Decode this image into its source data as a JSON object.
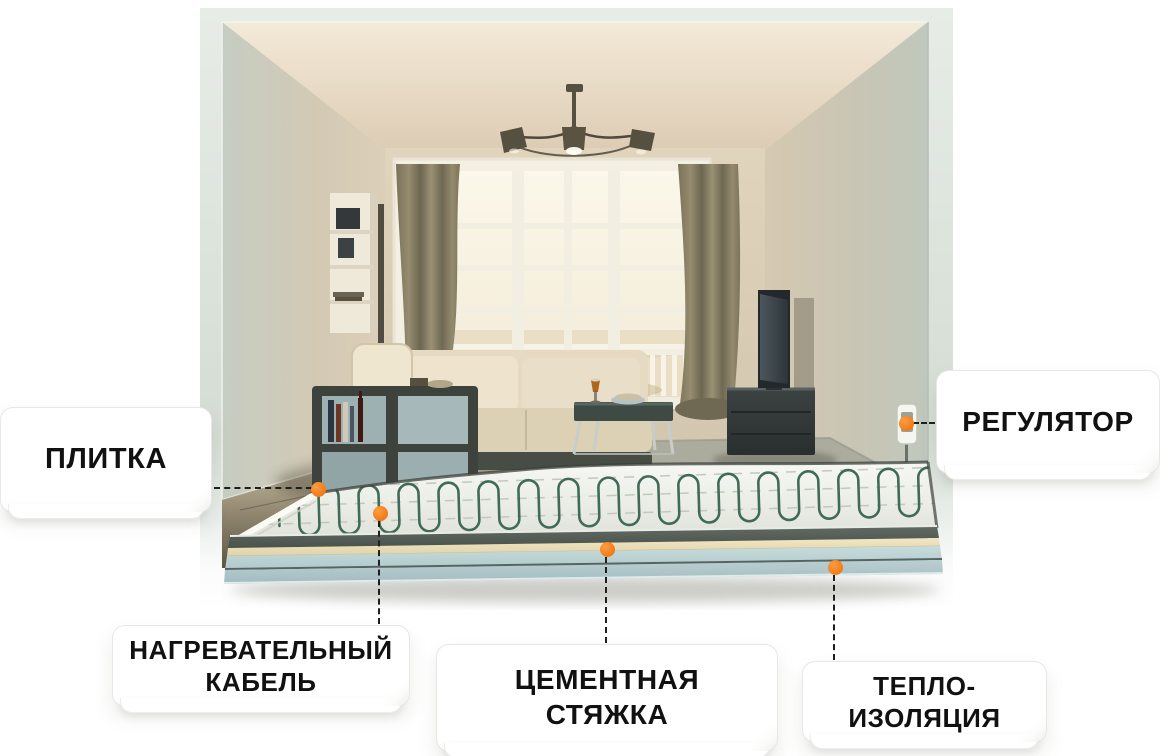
{
  "figure": {
    "kind": "underfloor-heating-cutaway-infographic"
  },
  "callouts": [
    {
      "id": "tile",
      "lines": [
        "ПЛИТКА"
      ]
    },
    {
      "id": "heating-cable",
      "lines": [
        "НАГРЕВАТЕЛЬНЫЙ",
        "КАБЕЛЬ"
      ]
    },
    {
      "id": "cement-screed",
      "lines": [
        "ЦЕМЕНТНАЯ",
        "СТЯЖКА"
      ]
    },
    {
      "id": "insulation",
      "lines": [
        "ТЕПЛО-",
        "ИЗОЛЯЦИЯ"
      ]
    },
    {
      "id": "regulator",
      "lines": [
        "РЕГУЛЯТОР"
      ]
    }
  ],
  "colors": {
    "accent_marker": "#F5821F",
    "card_background": "#FFFFFF",
    "card_border": "#E7E7E4",
    "label_text": "#111111",
    "connector_dash": "#1E1E1E",
    "outer_frame": "#DCE4DC",
    "room_wall": "#D6C9B4",
    "heating_cable": "#3F6B57",
    "heating_mat": "#F2F4EF",
    "screed_layer": "#ECE1BF",
    "insulation_board": "#BDD3D5",
    "dark_floor": "#6B6458"
  }
}
